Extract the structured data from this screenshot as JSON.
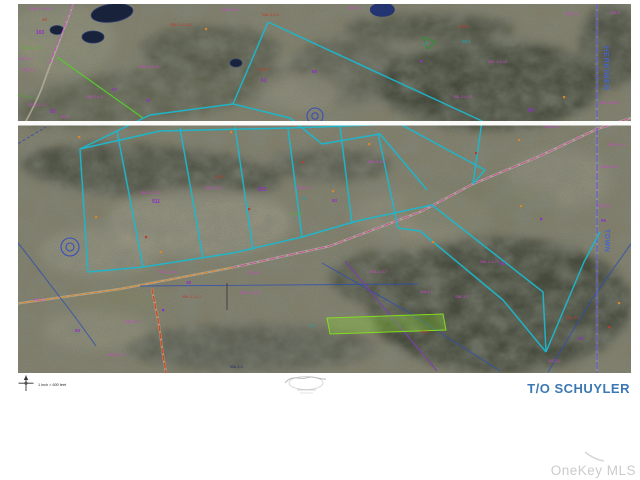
{
  "map": {
    "region_title": "T/O SCHUYLER",
    "scale_text": "1 inch = 600 feet",
    "edge_labels": {
      "county": "HERKIMER",
      "town": "TOWN"
    },
    "colors": {
      "parcel_boundary_cyan": "#1cb8cd",
      "county_text_blue": "#4563cf",
      "title_blue": "#3c78b4",
      "road_overlay_magenta": "#c8489a",
      "road_overlay_orange": "#d8862c",
      "road_red": "#d04c20",
      "stream_blue": "#2f4fae",
      "town_line_violet": "#5a46c8",
      "label_magenta": "#cf42cf",
      "label_purple": "#8e2fc6",
      "label_red": "#c03a2a",
      "label_teal": "#1f9fae",
      "label_green": "#4fb52e",
      "highlight_lime": "#8ade2a"
    },
    "labels": [
      {
        "x": 30,
        "y": 10,
        "t": "SBL 2-4-14.1",
        "c": "#cf42cf",
        "s": 3.8
      },
      {
        "x": 42,
        "y": 21,
        "t": "46",
        "c": "#c03a2a",
        "s": 4.5
      },
      {
        "x": 36,
        "y": 34,
        "t": "103",
        "c": "#8e2fc6",
        "s": 5,
        "b": 1
      },
      {
        "x": 22,
        "y": 49,
        "t": "SBL 2-4-6.2",
        "c": "#4fb52e",
        "s": 3.8
      },
      {
        "x": 18,
        "y": 60,
        "t": "103.4-1-7",
        "c": "#cf42cf",
        "s": 3.8
      },
      {
        "x": 22,
        "y": 71,
        "t": "SBL 2-4",
        "c": "#cf42cf",
        "s": 3.8
      },
      {
        "x": 28,
        "y": 106,
        "t": "103.2-1-2.1",
        "c": "#cf42cf",
        "s": 3.8
      },
      {
        "x": 50,
        "y": 113,
        "t": "93",
        "c": "#8e2fc6",
        "s": 5,
        "b": 1
      },
      {
        "x": 60,
        "y": 118,
        "t": "103.2",
        "c": "#cf42cf",
        "s": 3.8
      },
      {
        "x": 112,
        "y": 91,
        "t": "27",
        "c": "#8e2fc6",
        "s": 4.5,
        "b": 1
      },
      {
        "x": 86,
        "y": 98,
        "t": "SBL 2-4-5",
        "c": "#cf42cf",
        "s": 3.8
      },
      {
        "x": 140,
        "y": 68,
        "t": "SBL 2-4-74",
        "c": "#cf42cf",
        "s": 3.8
      },
      {
        "x": 146,
        "y": 102,
        "t": "57",
        "c": "#8e2fc6",
        "s": 4.5,
        "b": 1
      },
      {
        "x": 170,
        "y": 26,
        "t": "SBL 2-4-14.2",
        "c": "#c03a2a",
        "s": 3.8
      },
      {
        "x": 222,
        "y": 11,
        "t": "SBL 4-6-1",
        "c": "#cf42cf",
        "s": 3.8
      },
      {
        "x": 262,
        "y": 16,
        "t": "SBL 4-6-2",
        "c": "#c03a2a",
        "s": 3.8
      },
      {
        "x": 258,
        "y": 71,
        "t": "103-4",
        "c": "#c03a2a",
        "s": 4.2
      },
      {
        "x": 261,
        "y": 82,
        "t": "61",
        "c": "#8e2fc6",
        "s": 5,
        "b": 1
      },
      {
        "x": 312,
        "y": 73,
        "t": "88",
        "c": "#8e2fc6",
        "s": 4.5,
        "b": 1
      },
      {
        "x": 348,
        "y": 9,
        "t": "103.4-1",
        "c": "#cf42cf",
        "s": 3.8
      },
      {
        "x": 458,
        "y": 28,
        "t": "103.4",
        "c": "#c03a2a",
        "s": 4.2
      },
      {
        "x": 462,
        "y": 43,
        "t": "98.1",
        "c": "#1f9fae",
        "s": 4.5
      },
      {
        "x": 424,
        "y": 45,
        "t": "17",
        "c": "#1f9fae",
        "s": 4.5
      },
      {
        "x": 488,
        "y": 63,
        "t": "SBL 4-4-12",
        "c": "#cf42cf",
        "s": 3.8
      },
      {
        "x": 453,
        "y": 98,
        "t": "SBL 3-4-47",
        "c": "#cf42cf",
        "s": 3.8
      },
      {
        "x": 528,
        "y": 112,
        "t": "39",
        "c": "#8e2fc6",
        "s": 5,
        "b": 1
      },
      {
        "x": 565,
        "y": 15,
        "t": "SBL 4-4",
        "c": "#cf42cf",
        "s": 3.8
      },
      {
        "x": 610,
        "y": 14,
        "t": "264-4",
        "c": "#cf42cf",
        "s": 3.8
      },
      {
        "x": 600,
        "y": 104,
        "t": "SBL 3-4-25",
        "c": "#cf42cf",
        "s": 3.8
      },
      {
        "x": 608,
        "y": 146,
        "t": "SBL 3-4-4",
        "c": "#cf42cf",
        "s": 3.8
      },
      {
        "x": 601,
        "y": 168,
        "t": "SBL 4-4-5",
        "c": "#cf42cf",
        "s": 3.8
      },
      {
        "x": 140,
        "y": 194,
        "t": "SBL 2-2-7.1",
        "c": "#cf42cf",
        "s": 3.8
      },
      {
        "x": 152,
        "y": 203,
        "t": "911",
        "c": "#8e2fc6",
        "s": 5,
        "b": 1
      },
      {
        "x": 205,
        "y": 189,
        "t": "SBL 2-2-1",
        "c": "#cf42cf",
        "s": 3.8
      },
      {
        "x": 214,
        "y": 178,
        "t": "103.4",
        "c": "#c03a2a",
        "s": 4
      },
      {
        "x": 258,
        "y": 191,
        "t": "921",
        "c": "#8e2fc6",
        "s": 5,
        "b": 1
      },
      {
        "x": 297,
        "y": 189,
        "t": "SBL 3-4",
        "c": "#cf42cf",
        "s": 3.8
      },
      {
        "x": 301,
        "y": 200,
        "t": "78",
        "c": "#1f9fae",
        "s": 4.5
      },
      {
        "x": 332,
        "y": 202,
        "t": "93",
        "c": "#8e2fc6",
        "s": 4.5,
        "b": 1
      },
      {
        "x": 290,
        "y": 215,
        "t": "100-14",
        "c": "#4fb52e",
        "s": 4
      },
      {
        "x": 368,
        "y": 163,
        "t": "SBL 3-4-7",
        "c": "#cf42cf",
        "s": 3.8
      },
      {
        "x": 545,
        "y": 128,
        "t": "SBL 3-2",
        "c": "#cf42cf",
        "s": 3.8
      },
      {
        "x": 598,
        "y": 207,
        "t": "SBL 3-4",
        "c": "#cf42cf",
        "s": 3.8
      },
      {
        "x": 601,
        "y": 222,
        "t": "96",
        "c": "#8e2fc6",
        "s": 4.5,
        "b": 1
      },
      {
        "x": 33,
        "y": 301,
        "t": "108.2-1",
        "c": "#cf42cf",
        "s": 3.8
      },
      {
        "x": 75,
        "y": 332,
        "t": "93",
        "c": "#8e2fc6",
        "s": 4.5,
        "b": 1
      },
      {
        "x": 125,
        "y": 323,
        "t": "SBL 2-6",
        "c": "#cf42cf",
        "s": 3.8
      },
      {
        "x": 108,
        "y": 356,
        "t": "SBL 2-3-4",
        "c": "#cf42cf",
        "s": 3.8
      },
      {
        "x": 186,
        "y": 284,
        "t": "48",
        "c": "#8e2fc6",
        "s": 4.5,
        "b": 1
      },
      {
        "x": 158,
        "y": 273,
        "t": "SBL 2-3-14",
        "c": "#cf42cf",
        "s": 3.8
      },
      {
        "x": 248,
        "y": 274,
        "t": "75A-4-7",
        "c": "#cf42cf",
        "s": 3.8
      },
      {
        "x": 182,
        "y": 298,
        "t": "SBL 2-3-17",
        "c": "#c03a2a",
        "s": 3.8
      },
      {
        "x": 240,
        "y": 294,
        "t": "SBL 2-2-13",
        "c": "#cf42cf",
        "s": 3.8
      },
      {
        "x": 230,
        "y": 368,
        "t": "SBL 2-3",
        "c": "#1d2a66",
        "s": 3.5
      },
      {
        "x": 310,
        "y": 327,
        "t": "34",
        "c": "#1f9fae",
        "s": 4.2
      },
      {
        "x": 370,
        "y": 273,
        "t": "SBL 2-4-7",
        "c": "#cf42cf",
        "s": 3.8
      },
      {
        "x": 480,
        "y": 263,
        "t": "SBL 2-4-75",
        "c": "#cf42cf",
        "s": 3.8
      },
      {
        "x": 500,
        "y": 265,
        "t": "93",
        "c": "#8e2fc6",
        "s": 4.5,
        "b": 1
      },
      {
        "x": 420,
        "y": 293,
        "t": "108.4-1",
        "c": "#cf42cf",
        "s": 3.8
      },
      {
        "x": 455,
        "y": 298,
        "t": "SBL 3-7",
        "c": "#cf42cf",
        "s": 3.8
      },
      {
        "x": 420,
        "y": 333,
        "t": "108.4",
        "c": "#c03a2a",
        "s": 4
      },
      {
        "x": 566,
        "y": 319,
        "t": "SBL 3-1",
        "c": "#c03a2a",
        "s": 3.8
      },
      {
        "x": 578,
        "y": 340,
        "t": "90",
        "c": "#8e2fc6",
        "s": 4.5,
        "b": 1
      },
      {
        "x": 548,
        "y": 362,
        "t": "103.2-1",
        "c": "#cf42cf",
        "s": 3.8
      }
    ],
    "marks": [
      {
        "x": 78,
        "y": 136,
        "c": "#d8862c"
      },
      {
        "x": 230,
        "y": 131,
        "c": "#d8862c"
      },
      {
        "x": 368,
        "y": 143,
        "c": "#d8862c"
      },
      {
        "x": 518,
        "y": 139,
        "c": "#d8862c"
      },
      {
        "x": 160,
        "y": 251,
        "c": "#d8862c"
      },
      {
        "x": 332,
        "y": 190,
        "c": "#d8862c"
      },
      {
        "x": 563,
        "y": 96,
        "c": "#d8862c"
      },
      {
        "x": 618,
        "y": 302,
        "c": "#d8862c"
      },
      {
        "x": 95,
        "y": 216,
        "c": "#d8862c"
      },
      {
        "x": 432,
        "y": 241,
        "c": "#d8862c"
      },
      {
        "x": 205,
        "y": 28,
        "c": "#d8862c"
      },
      {
        "x": 520,
        "y": 205,
        "c": "#d8862c"
      },
      {
        "x": 248,
        "y": 208,
        "c": "#c03a2a"
      },
      {
        "x": 145,
        "y": 236,
        "c": "#c03a2a"
      },
      {
        "x": 475,
        "y": 152,
        "c": "#c03a2a"
      },
      {
        "x": 608,
        "y": 326,
        "c": "#c03a2a"
      },
      {
        "x": 302,
        "y": 161,
        "c": "#c03a2a"
      },
      {
        "x": 162,
        "y": 309,
        "c": "#8e2fc6"
      },
      {
        "x": 540,
        "y": 218,
        "c": "#8e2fc6"
      },
      {
        "x": 420,
        "y": 60,
        "c": "#8e2fc6"
      }
    ]
  },
  "watermark": {
    "text": "OneKey MLS"
  }
}
